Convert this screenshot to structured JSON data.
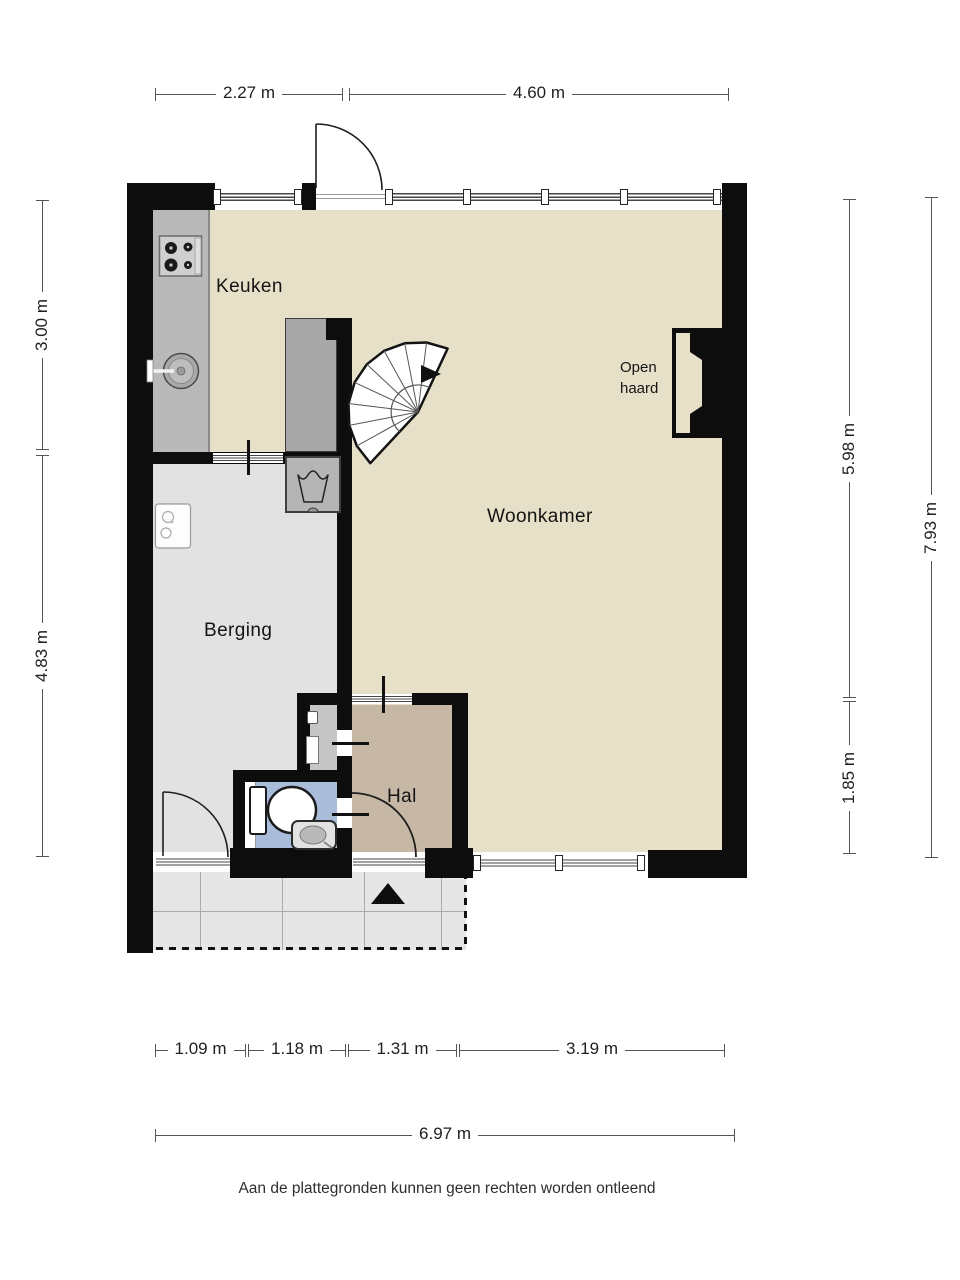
{
  "rooms": {
    "keuken": {
      "label": "Keuken"
    },
    "woonkamer": {
      "label": "Woonkamer"
    },
    "berging": {
      "label": "Berging"
    },
    "hal": {
      "label": "Hal"
    },
    "open_haard": {
      "label": "Open haard"
    }
  },
  "dimensions": {
    "top": [
      {
        "label": "2.27 m"
      },
      {
        "label": "4.60 m"
      }
    ],
    "left": [
      {
        "label": "3.00 m"
      },
      {
        "label": "4.83 m"
      }
    ],
    "right_inner": [
      {
        "label": "5.98 m"
      },
      {
        "label": "1.85 m"
      }
    ],
    "right_outer": {
      "label": "7.93 m"
    },
    "bottom": [
      {
        "label": "1.09 m"
      },
      {
        "label": "1.18 m"
      },
      {
        "label": "1.31 m"
      },
      {
        "label": "3.19 m"
      }
    ],
    "bottom_total": {
      "label": "6.97 m"
    }
  },
  "footer": {
    "disclaimer": "Aan de plattegronden kunnen geen rechten worden ontleend"
  },
  "fixtures": [
    "stove",
    "kitchen-sink",
    "boiler",
    "washing-machine",
    "spiral-staircase",
    "fireplace",
    "toilet",
    "hand-basin",
    "entrance-arrow"
  ],
  "colors": {
    "wall": "#0d0d0d",
    "floor_living": "#e7e0c9",
    "floor_storage": "#e2e2e2",
    "floor_closet": "#c6c6c6",
    "floor_hall": "#c7b8a5",
    "floor_toilet": "#a9bcd9",
    "terrace": "#e6e6e6",
    "counter": "#b9b9b9",
    "cabinet": "#a7a7a7",
    "text": "#1c1c1c"
  }
}
